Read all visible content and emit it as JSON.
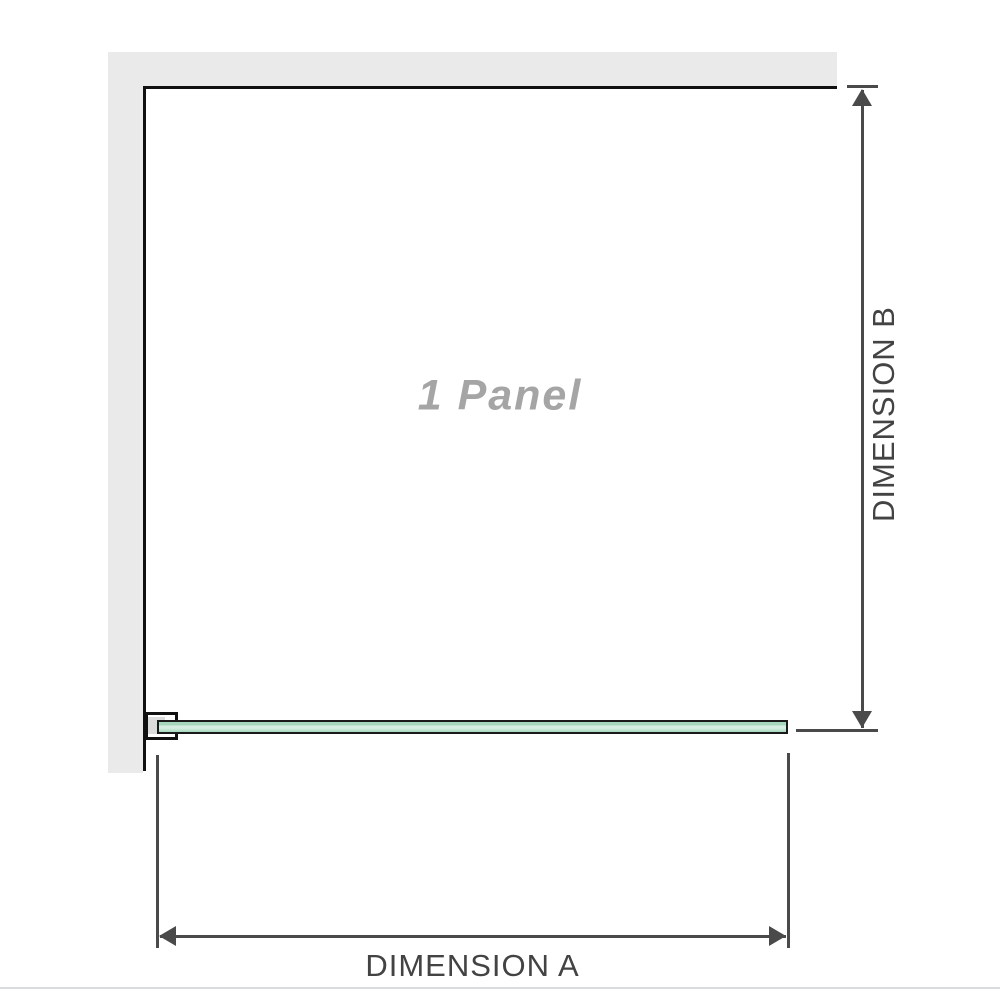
{
  "diagram": {
    "panel_label": "1 Panel",
    "dimension_a": {
      "label": "DIMENSION A"
    },
    "dimension_b": {
      "label": "DIMENSION B"
    }
  },
  "colors": {
    "wall": "#eaeaea",
    "outline": "#111111",
    "dimension_line": "#4a4a4a",
    "dimension_text": "#434343",
    "panel_text": "#a5a5a5",
    "glass_light": "#d6eee1",
    "glass_medium": "#a6d7bd",
    "glass_border": "#1a1a1a",
    "bracket_pad": "#dcdcdc",
    "bottom_rule": "#d9dcdd"
  }
}
